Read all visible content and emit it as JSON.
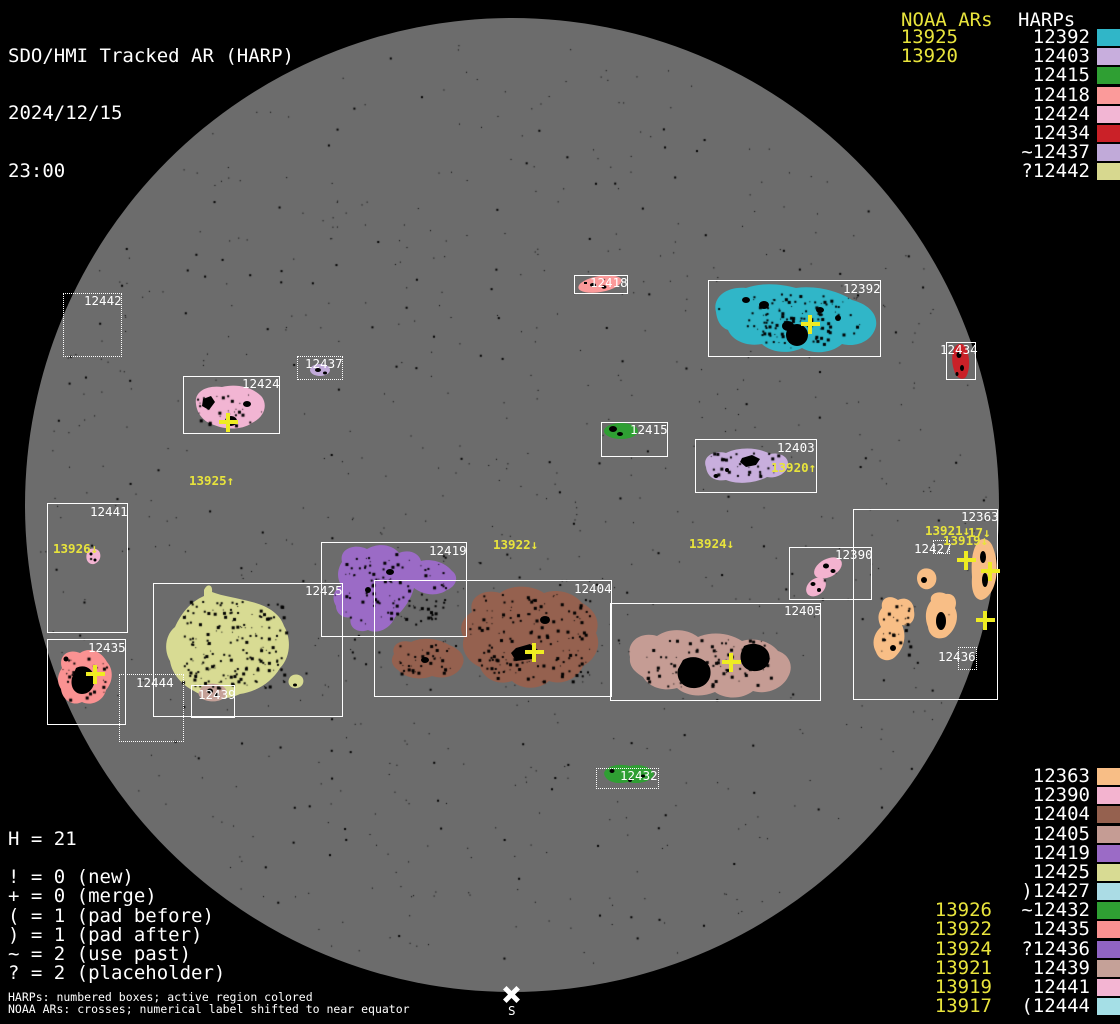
{
  "header": {
    "title": "SDO/HMI Tracked AR (HARP)",
    "date": "2024/12/15",
    "time": "23:00"
  },
  "legend_top": {
    "noaa_title": "NOAA ARs",
    "harp_title": "HARPs",
    "rows": [
      {
        "noaa": "13925",
        "harp": "12392",
        "color": "#30b6c8"
      },
      {
        "noaa": "13920",
        "harp": "12403",
        "color": "#c8aedd"
      },
      {
        "noaa": "",
        "harp": "12415",
        "color": "#2f9f33"
      },
      {
        "noaa": "",
        "harp": "12418",
        "color": "#fb9a9a"
      },
      {
        "noaa": "",
        "harp": "12424",
        "color": "#f2b5d3"
      },
      {
        "noaa": "",
        "harp": "12434",
        "color": "#ca2128"
      },
      {
        "noaa": "",
        "harp": "~12437",
        "color": "#c1aad9"
      },
      {
        "noaa": "",
        "harp": "?12442",
        "color": "#d7d88f"
      }
    ]
  },
  "legend_bottom": {
    "rows": [
      {
        "noaa": "",
        "harp": "12363",
        "color": "#f8be86"
      },
      {
        "noaa": "",
        "harp": "12390",
        "color": "#f3b3cf"
      },
      {
        "noaa": "",
        "harp": "12404",
        "color": "#95614f"
      },
      {
        "noaa": "",
        "harp": "12405",
        "color": "#c59c94"
      },
      {
        "noaa": "",
        "harp": "12419",
        "color": "#9b6bc6"
      },
      {
        "noaa": "",
        "harp": "12425",
        "color": "#d8db93"
      },
      {
        "noaa": "",
        "harp": ")12427",
        "color": "#abdce5"
      },
      {
        "noaa": "13926",
        "harp": "~12432",
        "color": "#2f9f33"
      },
      {
        "noaa": "13922",
        "harp": "12435",
        "color": "#fa9292"
      },
      {
        "noaa": "13924",
        "harp": "?12436",
        "color": "#9064c3"
      },
      {
        "noaa": "13921",
        "harp": "12439",
        "color": "#c5a198"
      },
      {
        "noaa": "13919",
        "harp": "12441",
        "color": "#f3b4d2"
      },
      {
        "noaa": "13917",
        "harp": "(12444",
        "color": "#a5dfe6"
      }
    ]
  },
  "stats": {
    "h_line": "H = 21",
    "lines": [
      "! = 0 (new)",
      "+ = 0 (merge)",
      "( = 1 (pad before)",
      ") = 1 (pad after)",
      "~ = 2 (use past)",
      "? = 2 (placeholder)"
    ]
  },
  "footer": {
    "line1": "HARPs: numbered boxes; active region colored",
    "line2": "NOAA ARs: crosses; numerical label shifted to near equator"
  },
  "south_marker": {
    "label": "S"
  },
  "region_colors": {
    "12392": "#30b6c8",
    "12403": "#c8aedd",
    "12415": "#2f9f33",
    "12418": "#fb9a9a",
    "12424": "#f2b5d3",
    "12434": "#ca2128",
    "12437": "#c1aad9",
    "12442": "#d7d88f",
    "12363": "#f8be86",
    "12390": "#f3b3cf",
    "12404": "#95614f",
    "12405": "#c59c94",
    "12419": "#9b6bc6",
    "12425": "#d8db93",
    "12427": "#abdce5",
    "12432": "#2f9f33",
    "12435": "#fa9292",
    "12436": "#9064c3",
    "12439": "#c5a198",
    "12441": "#f3b4d2",
    "12444": "#a5dfe6"
  },
  "harp_boxes": [
    {
      "label": "12442",
      "x": 63,
      "y": 293,
      "w": 59,
      "h": 64,
      "dotted": true,
      "lx": 84,
      "ly": 294
    },
    {
      "label": "12418",
      "x": 574,
      "y": 275,
      "w": 54,
      "h": 19,
      "dotted": false,
      "lx": 590,
      "ly": 276
    },
    {
      "label": "12392",
      "x": 708,
      "y": 280,
      "w": 173,
      "h": 77,
      "dotted": false,
      "lx": 843,
      "ly": 282
    },
    {
      "label": "12434",
      "x": 946,
      "y": 342,
      "w": 30,
      "h": 38,
      "dotted": false,
      "lx": 940,
      "ly": 343
    },
    {
      "label": "12437",
      "x": 297,
      "y": 356,
      "w": 46,
      "h": 24,
      "dotted": true,
      "lx": 305,
      "ly": 357
    },
    {
      "label": "12424",
      "x": 183,
      "y": 376,
      "w": 97,
      "h": 58,
      "dotted": false,
      "lx": 242,
      "ly": 377
    },
    {
      "label": "12415",
      "x": 601,
      "y": 422,
      "w": 67,
      "h": 35,
      "dotted": false,
      "lx": 630,
      "ly": 423
    },
    {
      "label": "12403",
      "x": 695,
      "y": 439,
      "w": 122,
      "h": 54,
      "dotted": false,
      "lx": 777,
      "ly": 441
    },
    {
      "label": "12441",
      "x": 47,
      "y": 503,
      "w": 81,
      "h": 130,
      "dotted": false,
      "lx": 90,
      "ly": 505
    },
    {
      "label": "12435",
      "x": 47,
      "y": 639,
      "w": 79,
      "h": 86,
      "dotted": false,
      "lx": 88,
      "ly": 641
    },
    {
      "label": "12444",
      "x": 119,
      "y": 674,
      "w": 65,
      "h": 68,
      "dotted": true,
      "lx": 136,
      "ly": 676
    },
    {
      "label": "12425",
      "x": 153,
      "y": 583,
      "w": 190,
      "h": 134,
      "dotted": false,
      "lx": 305,
      "ly": 584
    },
    {
      "label": "12439",
      "x": 191,
      "y": 685,
      "w": 44,
      "h": 33,
      "dotted": false,
      "lx": 198,
      "ly": 688
    },
    {
      "label": "12419",
      "x": 321,
      "y": 542,
      "w": 146,
      "h": 95,
      "dotted": false,
      "lx": 429,
      "ly": 544
    },
    {
      "label": "12404",
      "x": 374,
      "y": 580,
      "w": 238,
      "h": 117,
      "dotted": false,
      "lx": 574,
      "ly": 582
    },
    {
      "label": "12405",
      "x": 610,
      "y": 603,
      "w": 211,
      "h": 98,
      "dotted": false,
      "lx": 784,
      "ly": 604
    },
    {
      "label": "12390",
      "x": 789,
      "y": 547,
      "w": 83,
      "h": 53,
      "dotted": false,
      "lx": 835,
      "ly": 548
    },
    {
      "label": "12363",
      "x": 853,
      "y": 509,
      "w": 145,
      "h": 191,
      "dotted": false,
      "lx": 961,
      "ly": 510
    },
    {
      "label": "12427",
      "x": 933,
      "y": 540,
      "w": 17,
      "h": 14,
      "dotted": true,
      "lx": 914,
      "ly": 542
    },
    {
      "label": "12436",
      "x": 958,
      "y": 647,
      "w": 19,
      "h": 23,
      "dotted": true,
      "lx": 938,
      "ly": 650
    },
    {
      "label": "12432",
      "x": 596,
      "y": 768,
      "w": 63,
      "h": 21,
      "dotted": true,
      "lx": 620,
      "ly": 769
    }
  ],
  "noaa_labels": [
    {
      "text": "13925↑",
      "x": 189,
      "y": 474
    },
    {
      "text": "13926↓",
      "x": 53,
      "y": 542
    },
    {
      "text": "13922↓",
      "x": 493,
      "y": 538
    },
    {
      "text": "13924↓",
      "x": 689,
      "y": 537
    },
    {
      "text": "13920↑",
      "x": 771,
      "y": 461
    },
    {
      "text": "13921↓",
      "x": 925,
      "y": 524
    },
    {
      "text": "17↓",
      "x": 968,
      "y": 526
    },
    {
      "text": "13919↓",
      "x": 943,
      "y": 534
    }
  ],
  "crosses": [
    {
      "x": 810,
      "y": 324
    },
    {
      "x": 228,
      "y": 422
    },
    {
      "x": 95,
      "y": 674
    },
    {
      "x": 534,
      "y": 652
    },
    {
      "x": 731,
      "y": 662
    },
    {
      "x": 966,
      "y": 560
    },
    {
      "x": 990,
      "y": 571
    },
    {
      "x": 985,
      "y": 620
    }
  ]
}
